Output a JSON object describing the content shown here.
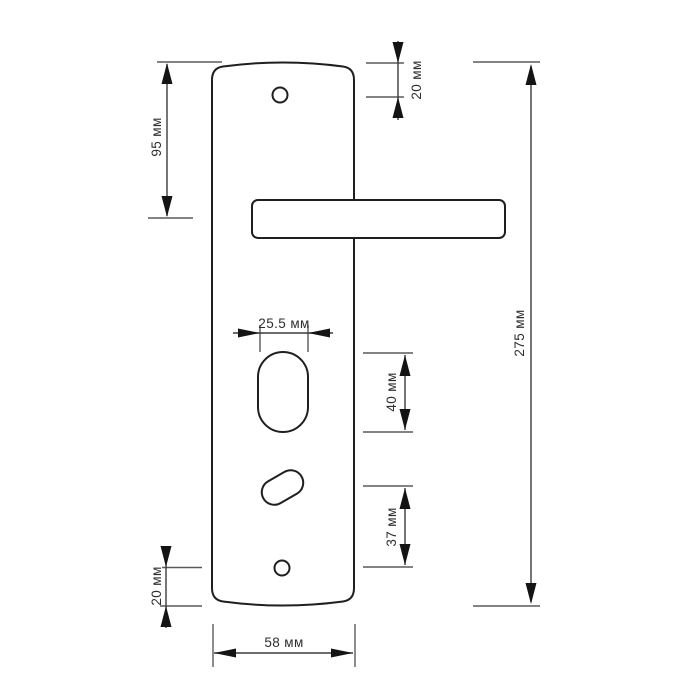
{
  "drawing": {
    "object": "door-handle-backplate-dimension-drawing",
    "unit": "мм",
    "labels": {
      "plate_top_to_handle_center": "95 мм",
      "plate_top_to_top_screw": "20 мм",
      "overall_plate_height": "275 мм",
      "cylinder_hole_width": "25.5 мм",
      "cylinder_hole_height": "40 мм",
      "keyhole_to_bottom_screw": "37 мм",
      "bottom_screw_to_plate_bottom": "20 мм",
      "plate_width": "58 мм"
    },
    "colors": {
      "outline": "#1f1f1f",
      "dimension_line": "#3c3c3c",
      "extension_line": "#5a5a5a",
      "arrow": "#141414",
      "label_text": "#2e2e2e",
      "background": "#ffffff"
    }
  }
}
